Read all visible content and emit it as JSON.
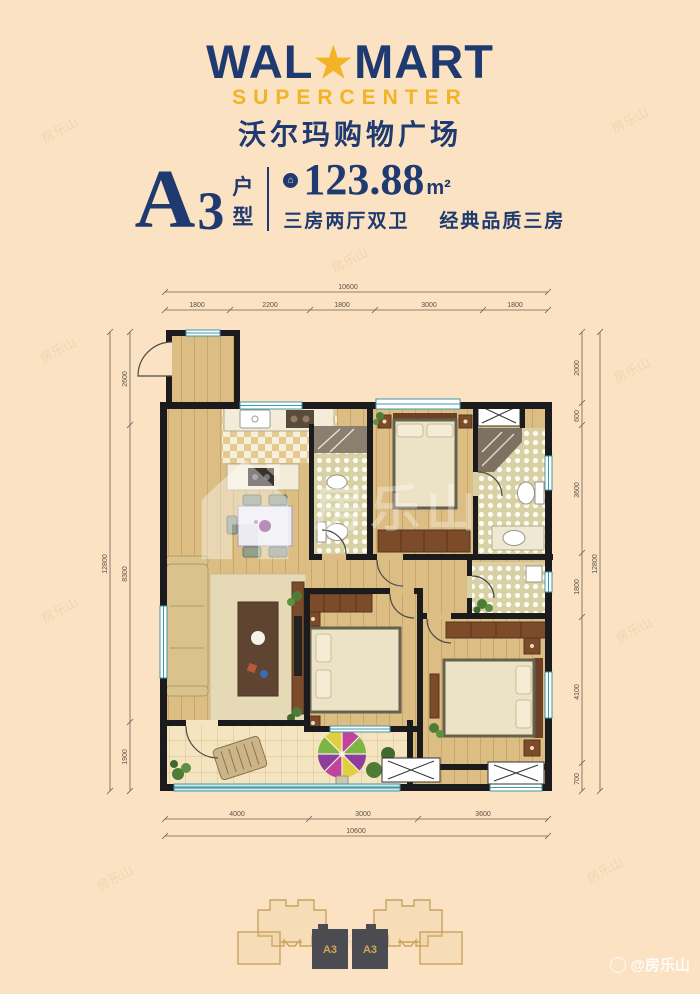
{
  "logo": {
    "wal": "WAL",
    "star": "★",
    "mart": "MART",
    "subtitle": "SUPERCENTER",
    "chinese": "沃尔玛购物广场",
    "navy": "#1e3a70",
    "gold": "#f2b426"
  },
  "unit": {
    "letter": "A",
    "number": "3",
    "type_char_1": "户",
    "type_char_2": "型",
    "area_icon": "house-badge",
    "area_value": "123.88",
    "area_unit": "m²",
    "tagline_left": "三房两厅双卫",
    "tagline_right": "经典品质三房"
  },
  "floorplan": {
    "dimensions": {
      "top_total": "10600",
      "top_segments": [
        "1800",
        "2200",
        "1800",
        "3000",
        "1800"
      ],
      "bottom_segments": [
        "4000",
        "3000",
        "3600"
      ],
      "bottom_total": "10600",
      "left_total": "12800",
      "left_segments": [
        "2600",
        "8300",
        "1900"
      ],
      "right_segments": [
        "2000",
        "600",
        "3600",
        "1800",
        "4100",
        "700"
      ],
      "right_total": "12800"
    },
    "wall_color": "#1b1b1d",
    "window_color": "#3f98a6",
    "wood_color": "#dcbd84"
  },
  "keyplan": {
    "unit_left": "A3",
    "unit_right": "A3"
  },
  "watermark": {
    "tile_text": "房乐山",
    "center_text": "房乐山",
    "credit": "@房乐山"
  }
}
